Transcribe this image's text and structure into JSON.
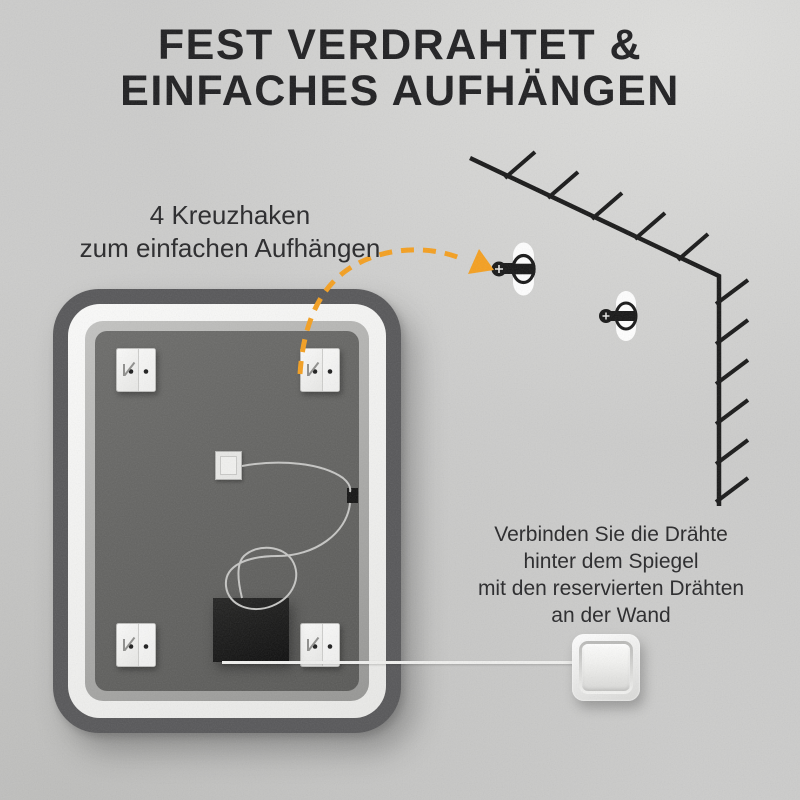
{
  "title": {
    "line1": "FEST VERDRAHTET &",
    "line2": "EINFACHES AUFHÄNGEN"
  },
  "annotations": {
    "hooks": {
      "line1": "4 Kreuzhaken",
      "line2": "zum einfachen Aufhängen"
    },
    "wiring": {
      "lines": [
        "Verbinden Sie die Drähte",
        "hinter dem Spiegel",
        "mit den reservierten Drähten",
        "an der Wand"
      ]
    }
  },
  "illustration": {
    "counts": {
      "cross_hooks": 4,
      "wall_anchors": 2
    },
    "icons": [
      "cross-hook-plate-icon",
      "wall-anchor-icon",
      "wall-corner-sketch",
      "dashed-arrow",
      "junction-box",
      "led-driver-box",
      "internal-wire",
      "power-cable",
      "light-switch"
    ]
  },
  "colors": {
    "accent_orange": "#F59F1E",
    "title_text": "#1D1D1F",
    "body_text": "#262628",
    "wall_background": "#CCCCCB",
    "mirror_frame_dark": "#565658",
    "mirror_frame_white": "#F4F4F2",
    "mirror_frame_gray": "#A5A5A3",
    "mirror_panel": "#616160",
    "driver_box": "#141414",
    "wire": "#C6C6C4",
    "power_cable": "#F0F0EE",
    "sketch_line": "#161616"
  }
}
